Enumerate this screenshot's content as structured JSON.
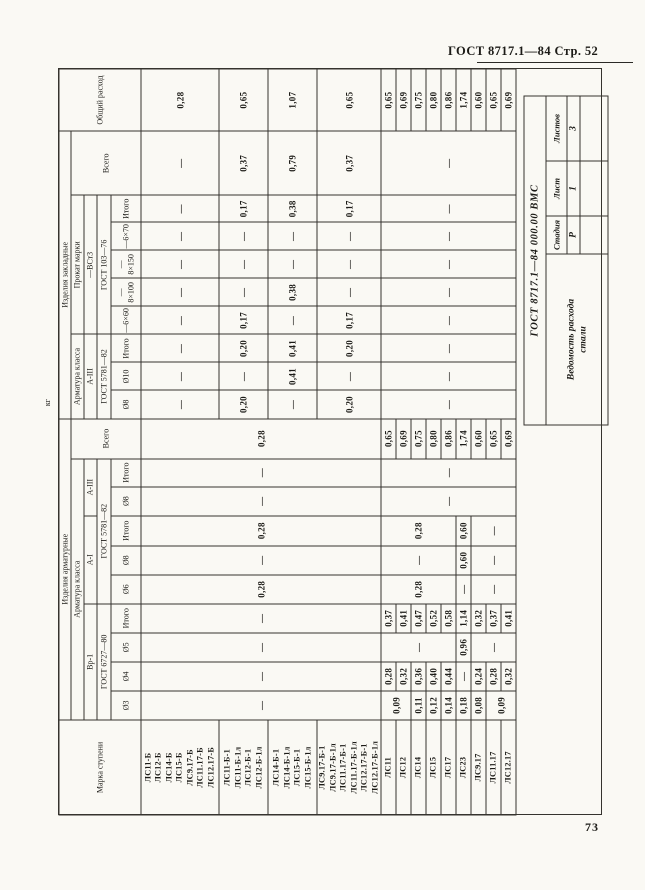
{
  "page": {
    "header": "ГОСТ 8717.1—84 Стр. 52",
    "page_number": "73",
    "unit_label": "кг"
  },
  "stamp": {
    "doc_number": "ГОСТ 8717.1—84 000.00 ВМС",
    "title_line1": "Ведомость расхода",
    "title_line2": "стали",
    "cols": [
      {
        "label": "Стадия",
        "value": "Р"
      },
      {
        "label": "Лист",
        "value": "1"
      },
      {
        "label": "Листов",
        "value": "3"
      }
    ]
  },
  "table": {
    "col_widths": [
      95,
      29,
      29,
      29,
      29,
      29,
      29,
      30,
      29,
      28,
      40,
      28,
      28,
      28,
      28,
      28,
      28,
      28,
      27,
      64,
      62
    ],
    "header_rows": [
      {
        "h": 12,
        "cells": [
          {
            "t": "Марка ступени",
            "rs": 5
          },
          {
            "t": "Изделия арматурные",
            "cs": 10
          },
          {
            "t": "Изделия закладные",
            "cs": 9
          },
          {
            "t": "Общий расход",
            "rs": 5
          }
        ]
      },
      {
        "h": 13,
        "cells": [
          {
            "t": "Арматура класса",
            "cs": 9
          },
          {
            "t": "Всего",
            "rs": 4
          },
          {
            "t": "Арматура класса",
            "cs": 3
          },
          {
            "t": "Прокат марки",
            "cs": 5
          },
          {
            "t": "Всего",
            "rs": 4
          }
        ]
      },
      {
        "h": 13,
        "cells": [
          {
            "t": "Вр-1",
            "cs": 4
          },
          {
            "t": "А-I",
            "cs": 3
          },
          {
            "t": "А-III",
            "cs": 2
          },
          {
            "t": "А-III",
            "cs": 3
          },
          {
            "t": "—ВСт3",
            "cs": 5
          }
        ]
      },
      {
        "h": 14,
        "cells": [
          {
            "t": "ГОСТ 6727—80",
            "cs": 4
          },
          {
            "t": "ГОСТ 5781—82",
            "cs": 5
          },
          {
            "t": "ГОСТ 5781—82",
            "cs": 3
          },
          {
            "t": "ГОСТ 103—76",
            "cs": 5
          }
        ]
      },
      {
        "h": 30,
        "cells": [
          {
            "t": "Ø3"
          },
          {
            "t": "Ø4"
          },
          {
            "t": "Ø5"
          },
          {
            "t": "Итого"
          },
          {
            "t": "Ø6"
          },
          {
            "t": "Ø8"
          },
          {
            "t": "Итого"
          },
          {
            "t": "Ø8"
          },
          {
            "t": "Итого"
          },
          {
            "t": "Ø8"
          },
          {
            "t": "Ø10"
          },
          {
            "t": "Итого"
          },
          {
            "t": "—6×60"
          },
          {
            "t": "—8×100"
          },
          {
            "t": "—8×150"
          },
          {
            "t": "—6×70"
          },
          {
            "t": "Итого"
          }
        ]
      }
    ],
    "body_rows": [
      {
        "h": 78,
        "cells": [
          {
            "t": "ЛС11-Б\nЛС12-Б\nЛС14-Б\nЛС15-Б\nЛС9.17-Б\nЛС11.17-Б\nЛС12.17-Б",
            "cls": "marks"
          },
          {
            "t": "—",
            "rs": 4
          },
          {
            "t": "—",
            "rs": 4
          },
          {
            "t": "—",
            "rs": 4
          },
          {
            "t": "—",
            "rs": 4
          },
          {
            "t": "0,28",
            "rs": 4
          },
          {
            "t": "—",
            "rs": 4
          },
          {
            "t": "0,28",
            "rs": 4
          },
          {
            "t": "—",
            "rs": 4
          },
          {
            "t": "—",
            "rs": 4
          },
          {
            "t": "0,28",
            "rs": 4
          },
          {
            "t": "—"
          },
          {
            "t": "—"
          },
          {
            "t": "—"
          },
          {
            "t": "—"
          },
          {
            "t": "—"
          },
          {
            "t": "—"
          },
          {
            "t": "—"
          },
          {
            "t": "—"
          },
          {
            "t": "—"
          },
          {
            "t": "0,28"
          }
        ]
      },
      {
        "h": 49,
        "cells": [
          {
            "t": "ЛС11-Б-1\nЛС11-Б-1л\nЛС12-Б-1\nЛС12-Б-1л",
            "cls": "marks"
          },
          {
            "t": "0,20"
          },
          {
            "t": "—"
          },
          {
            "t": "0,20"
          },
          {
            "t": "0,17"
          },
          {
            "t": "—"
          },
          {
            "t": "—"
          },
          {
            "t": "—"
          },
          {
            "t": "0,17"
          },
          {
            "t": "0,37"
          },
          {
            "t": "0,65"
          }
        ]
      },
      {
        "h": 49,
        "cells": [
          {
            "t": "ЛС14-Б-1\nЛС14-Б-1л\nЛС15-Б-1\nЛС15-Б-1л",
            "cls": "marks"
          },
          {
            "t": "—"
          },
          {
            "t": "0,41"
          },
          {
            "t": "0,41"
          },
          {
            "t": "—"
          },
          {
            "t": "0,38"
          },
          {
            "t": "—"
          },
          {
            "t": "—"
          },
          {
            "t": "0,38"
          },
          {
            "t": "0,79"
          },
          {
            "t": "1,07"
          }
        ]
      },
      {
        "h": 53,
        "cells": [
          {
            "t": "ЛС9.17-Б-1\nЛС9.17-Б-1л\nЛС11.17-Б-1\nЛС11.17-Б-1л\nЛС12.17-Б-1\nЛС12.17-Б-1л",
            "cls": "marks"
          },
          {
            "t": "0,20"
          },
          {
            "t": "—"
          },
          {
            "t": "0,20"
          },
          {
            "t": "0,17"
          },
          {
            "t": "—"
          },
          {
            "t": "—"
          },
          {
            "t": "—"
          },
          {
            "t": "0,17"
          },
          {
            "t": "0,37"
          },
          {
            "t": "0,65"
          }
        ]
      },
      {
        "h": 15,
        "cells": [
          {
            "t": "ЛС11",
            "cls": "marks"
          },
          {
            "t": "0,09",
            "rs": 2
          },
          {
            "t": "0,28"
          },
          {
            "t": "—",
            "rs": 5
          },
          {
            "t": "0,37"
          },
          {
            "t": "0,28",
            "rs": 5
          },
          {
            "t": "—",
            "rs": 5
          },
          {
            "t": "0,28",
            "rs": 5
          },
          {
            "t": "—",
            "rs": 9
          },
          {
            "t": "—",
            "rs": 9
          },
          {
            "t": "0,65"
          },
          {
            "t": "—",
            "rs": 9
          },
          {
            "t": "—",
            "rs": 9
          },
          {
            "t": "—",
            "rs": 9
          },
          {
            "t": "—",
            "rs": 9
          },
          {
            "t": "—",
            "rs": 9
          },
          {
            "t": "—",
            "rs": 9
          },
          {
            "t": "—",
            "rs": 9
          },
          {
            "t": "—",
            "rs": 9
          },
          {
            "t": "—",
            "rs": 9
          },
          {
            "t": "0,65"
          }
        ]
      },
      {
        "h": 15,
        "cells": [
          {
            "t": "ЛС12",
            "cls": "marks"
          },
          {
            "t": "0,32"
          },
          {
            "t": "0,41"
          },
          {
            "t": "0,69"
          },
          {
            "t": "0,69"
          }
        ]
      },
      {
        "h": 15,
        "cells": [
          {
            "t": "ЛС14",
            "cls": "marks"
          },
          {
            "t": "0,11"
          },
          {
            "t": "0,36"
          },
          {
            "t": "0,47"
          },
          {
            "t": "0,75"
          },
          {
            "t": "0,75"
          }
        ]
      },
      {
        "h": 15,
        "cells": [
          {
            "t": "ЛС15",
            "cls": "marks"
          },
          {
            "t": "0,12"
          },
          {
            "t": "0,40"
          },
          {
            "t": "0,52"
          },
          {
            "t": "0,80"
          },
          {
            "t": "0,80"
          }
        ]
      },
      {
        "h": 15,
        "cells": [
          {
            "t": "ЛС17",
            "cls": "marks"
          },
          {
            "t": "0,14"
          },
          {
            "t": "0,44"
          },
          {
            "t": "0,58"
          },
          {
            "t": "0,86"
          },
          {
            "t": "0,86"
          }
        ]
      },
      {
        "h": 15,
        "cells": [
          {
            "t": "ЛС23",
            "cls": "marks"
          },
          {
            "t": "0,18"
          },
          {
            "t": "—"
          },
          {
            "t": "0,96"
          },
          {
            "t": "1,14"
          },
          {
            "t": "—"
          },
          {
            "t": "0,60"
          },
          {
            "t": "0,60"
          },
          {
            "t": "1,74"
          },
          {
            "t": "1,74"
          }
        ]
      },
      {
        "h": 15,
        "cells": [
          {
            "t": "ЛС9.17",
            "cls": "marks"
          },
          {
            "t": "0,08"
          },
          {
            "t": "0,24"
          },
          {
            "t": "—",
            "rs": 3
          },
          {
            "t": "0,32"
          },
          {
            "t": "—",
            "rs": 3
          },
          {
            "t": "—",
            "rs": 3
          },
          {
            "t": "—",
            "rs": 3
          },
          {
            "t": "0,60"
          },
          {
            "t": "0,60"
          }
        ]
      },
      {
        "h": 15,
        "cells": [
          {
            "t": "ЛС11.17",
            "cls": "marks"
          },
          {
            "t": "0,09",
            "rs": 2
          },
          {
            "t": "0,28"
          },
          {
            "t": "0,37"
          },
          {
            "t": "0,65"
          },
          {
            "t": "0,65"
          }
        ]
      },
      {
        "h": 15,
        "cells": [
          {
            "t": "ЛС12.17",
            "cls": "marks"
          },
          {
            "t": "0,32"
          },
          {
            "t": "0,41"
          },
          {
            "t": "0,69"
          },
          {
            "t": "0,69"
          }
        ]
      }
    ]
  }
}
